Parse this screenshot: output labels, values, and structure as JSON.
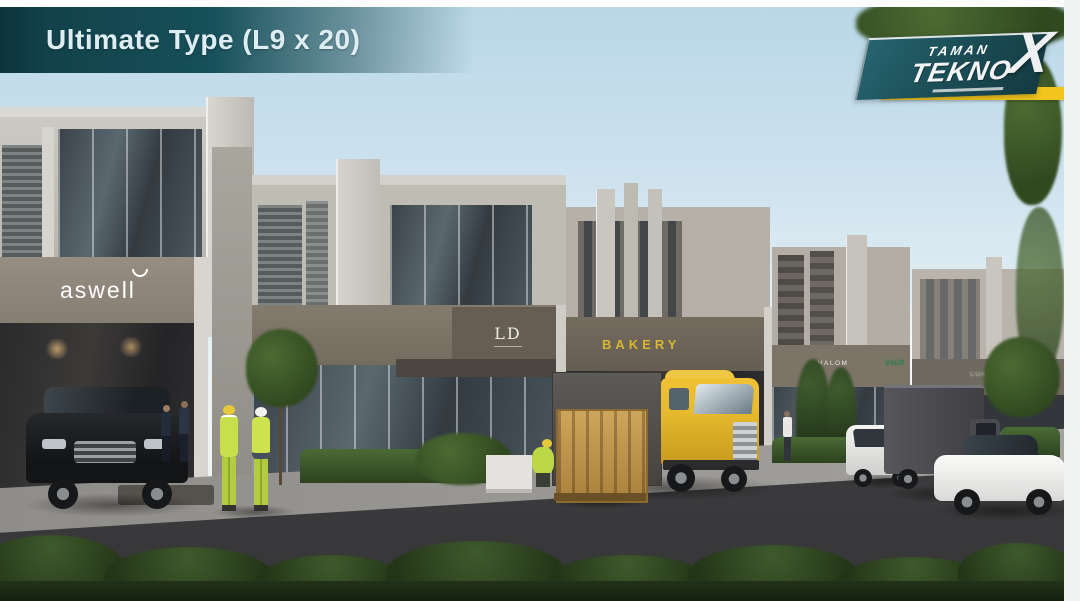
{
  "title_banner": {
    "text": "Ultimate Type (L9 x 20)"
  },
  "logo": {
    "line1": "TAMAN",
    "line2": "TEKNO",
    "x_mark": "X"
  },
  "signs": {
    "aswell": "aswell",
    "aswell_mark_icon": "smile-arc",
    "monogram": "LD",
    "bakery": "BAKERY",
    "truck_container": "BAKERY",
    "right_sign_1": "SHALOM",
    "right_sign_2": "Vault",
    "far_right_sign": "CONCEPTS"
  },
  "colors": {
    "banner": "#17505a",
    "logo_plate": "#1c4f58",
    "logo_stripe": "#f1c51e",
    "sky": "#b9d7e7",
    "bakery_sign": "#d9b634",
    "vault_sign": "#2f7a4f",
    "truck_yellow": "#e7ba2e",
    "road": "#454547",
    "hedge": "#22331a"
  }
}
